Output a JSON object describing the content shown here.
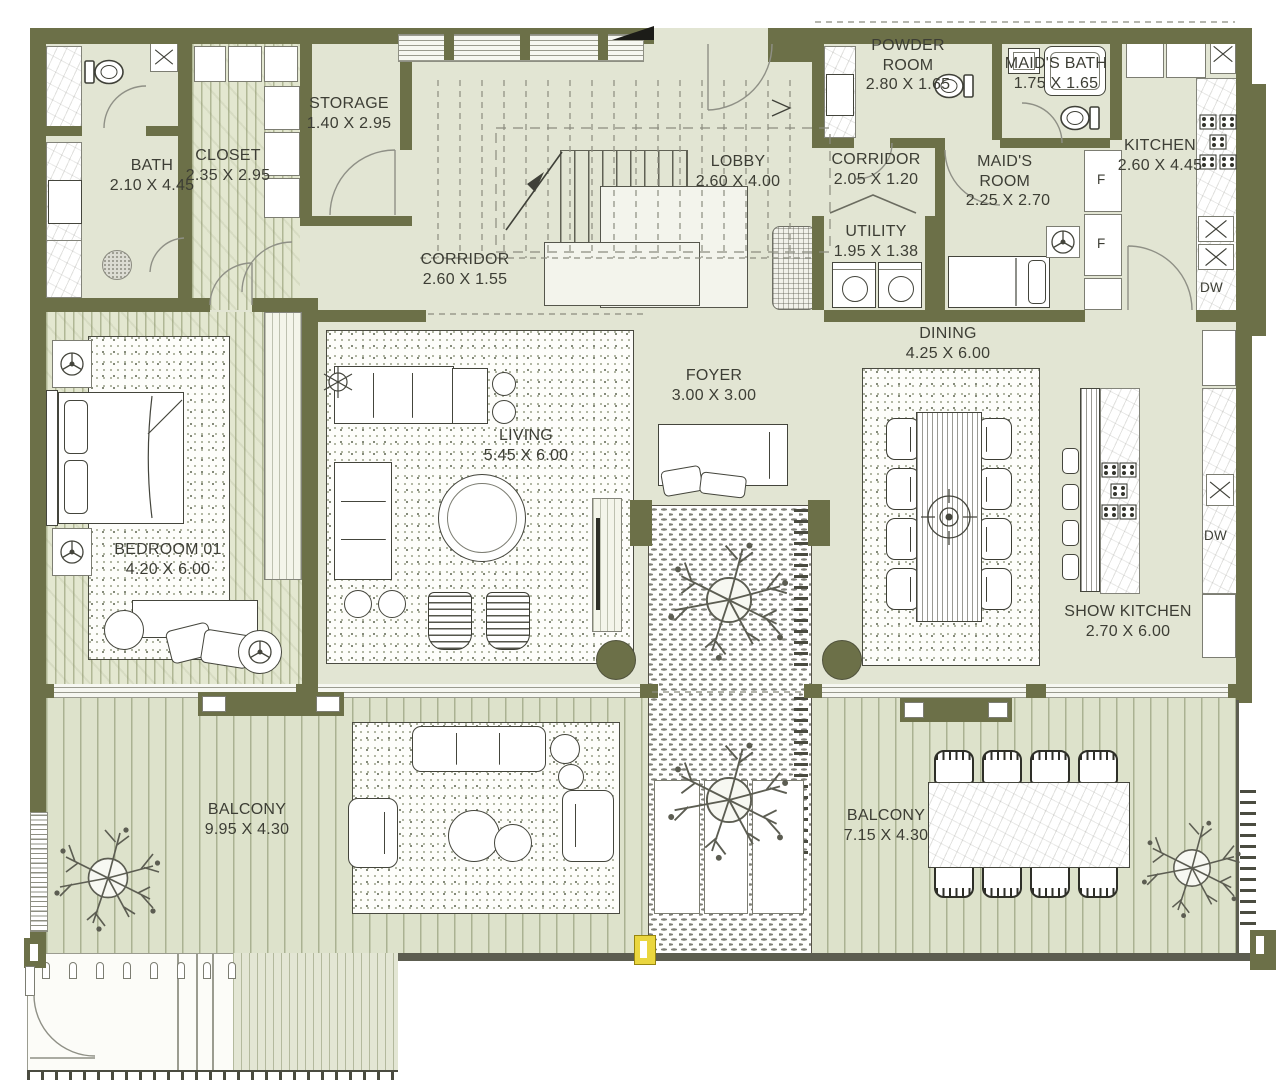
{
  "page": {
    "type": "architectural floor plan"
  },
  "rooms": {
    "bath": {
      "name": "BATH",
      "dims": "2.10 X 4.45"
    },
    "closet": {
      "name": "CLOSET",
      "dims": "2.35 X 2.95"
    },
    "storage": {
      "name": "STORAGE",
      "dims": "1.40 X 2.95"
    },
    "lobby": {
      "name": "LOBBY",
      "dims": "2.60 X 4.00"
    },
    "corridor_main": {
      "name": "CORRIDOR",
      "dims": "2.60 X 1.55"
    },
    "powder_room": {
      "name": "POWDER ROOM",
      "dims": "2.80 X 1.65"
    },
    "maids_bath": {
      "name": "MAID'S BATH",
      "dims": "1.75 X 1.65"
    },
    "corridor_top": {
      "name": "CORRIDOR",
      "dims": "2.05 X 1.20"
    },
    "maids_room": {
      "name": "MAID'S ROOM",
      "dims": "2.25 X 2.70"
    },
    "utility": {
      "name": "UTILITY",
      "dims": "1.95 X 1.38"
    },
    "kitchen": {
      "name": "KITCHEN",
      "dims": "2.60 X 4.45"
    },
    "dining": {
      "name": "DINING",
      "dims": "4.25 X 6.00"
    },
    "foyer": {
      "name": "FOYER",
      "dims": "3.00 X 3.00"
    },
    "living": {
      "name": "LIVING",
      "dims": "5.45 X 6.00"
    },
    "bedroom_01": {
      "name": "BEDROOM 01",
      "dims": "4.20 X 6.00"
    },
    "show_kitchen": {
      "name": "SHOW KITCHEN",
      "dims": "2.70 X 6.00"
    },
    "balcony_left": {
      "name": "BALCONY",
      "dims": "9.95 X 4.30"
    },
    "balcony_right": {
      "name": "BALCONY",
      "dims": "7.15 X 4.30"
    }
  },
  "appliances": {
    "fridge_label": "F",
    "dishwasher_label": "DW"
  },
  "colors": {
    "wall": "#6C7048",
    "floor": "#E2E5D3",
    "deck": "#DDE2CB",
    "accent_highlight": "#EAD63F",
    "text": "#3D3E35"
  }
}
